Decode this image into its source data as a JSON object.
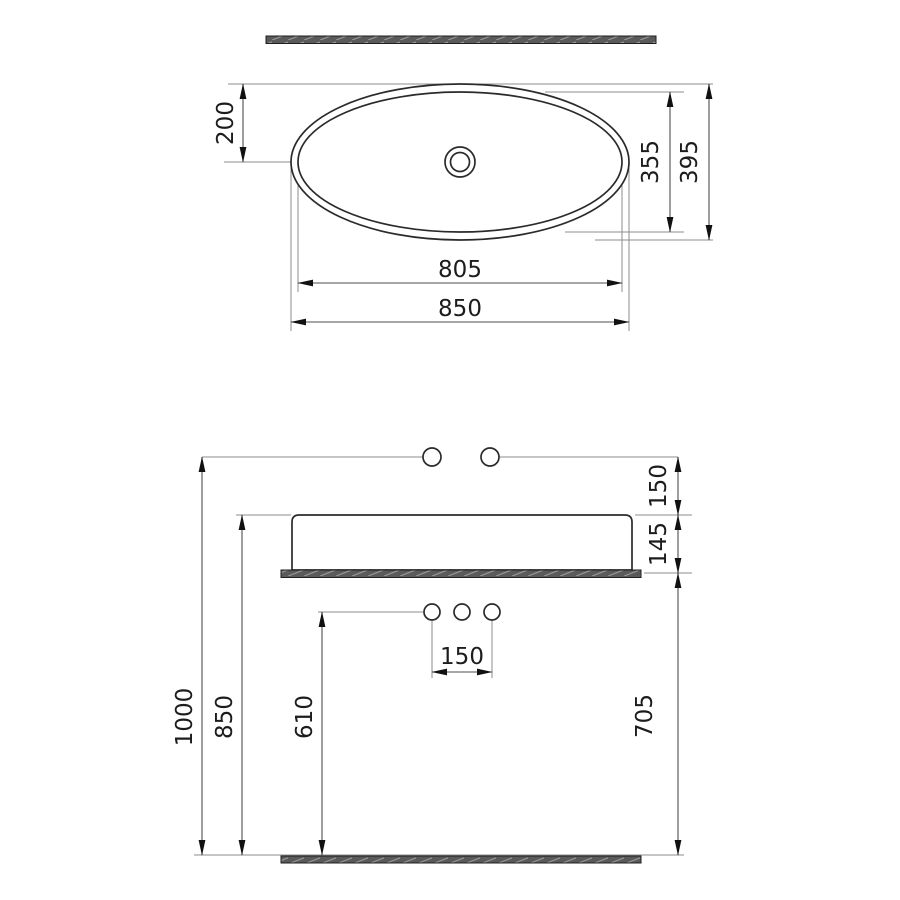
{
  "drawing_title": "oval-countertop-washbasin-dimension-drawing",
  "units_implied": "mm",
  "top_view": {
    "drain_to_edge": "200",
    "inner_depth": "355",
    "outer_depth": "395",
    "inner_length": "805",
    "outer_length": "850"
  },
  "front_view": {
    "wall_to_rim": "150",
    "basin_height": "145",
    "total_height": "1000",
    "rim_height": "850",
    "supply_height": "610",
    "supply_spacing": "150",
    "counter_clearance": "705"
  },
  "colors": {
    "object_line": "#2b2b2b",
    "dimension_line": "#4e4e4e",
    "extension_line": "#8c8c8c",
    "slab_fill": "#5a5a5a",
    "background": "#ffffff"
  }
}
